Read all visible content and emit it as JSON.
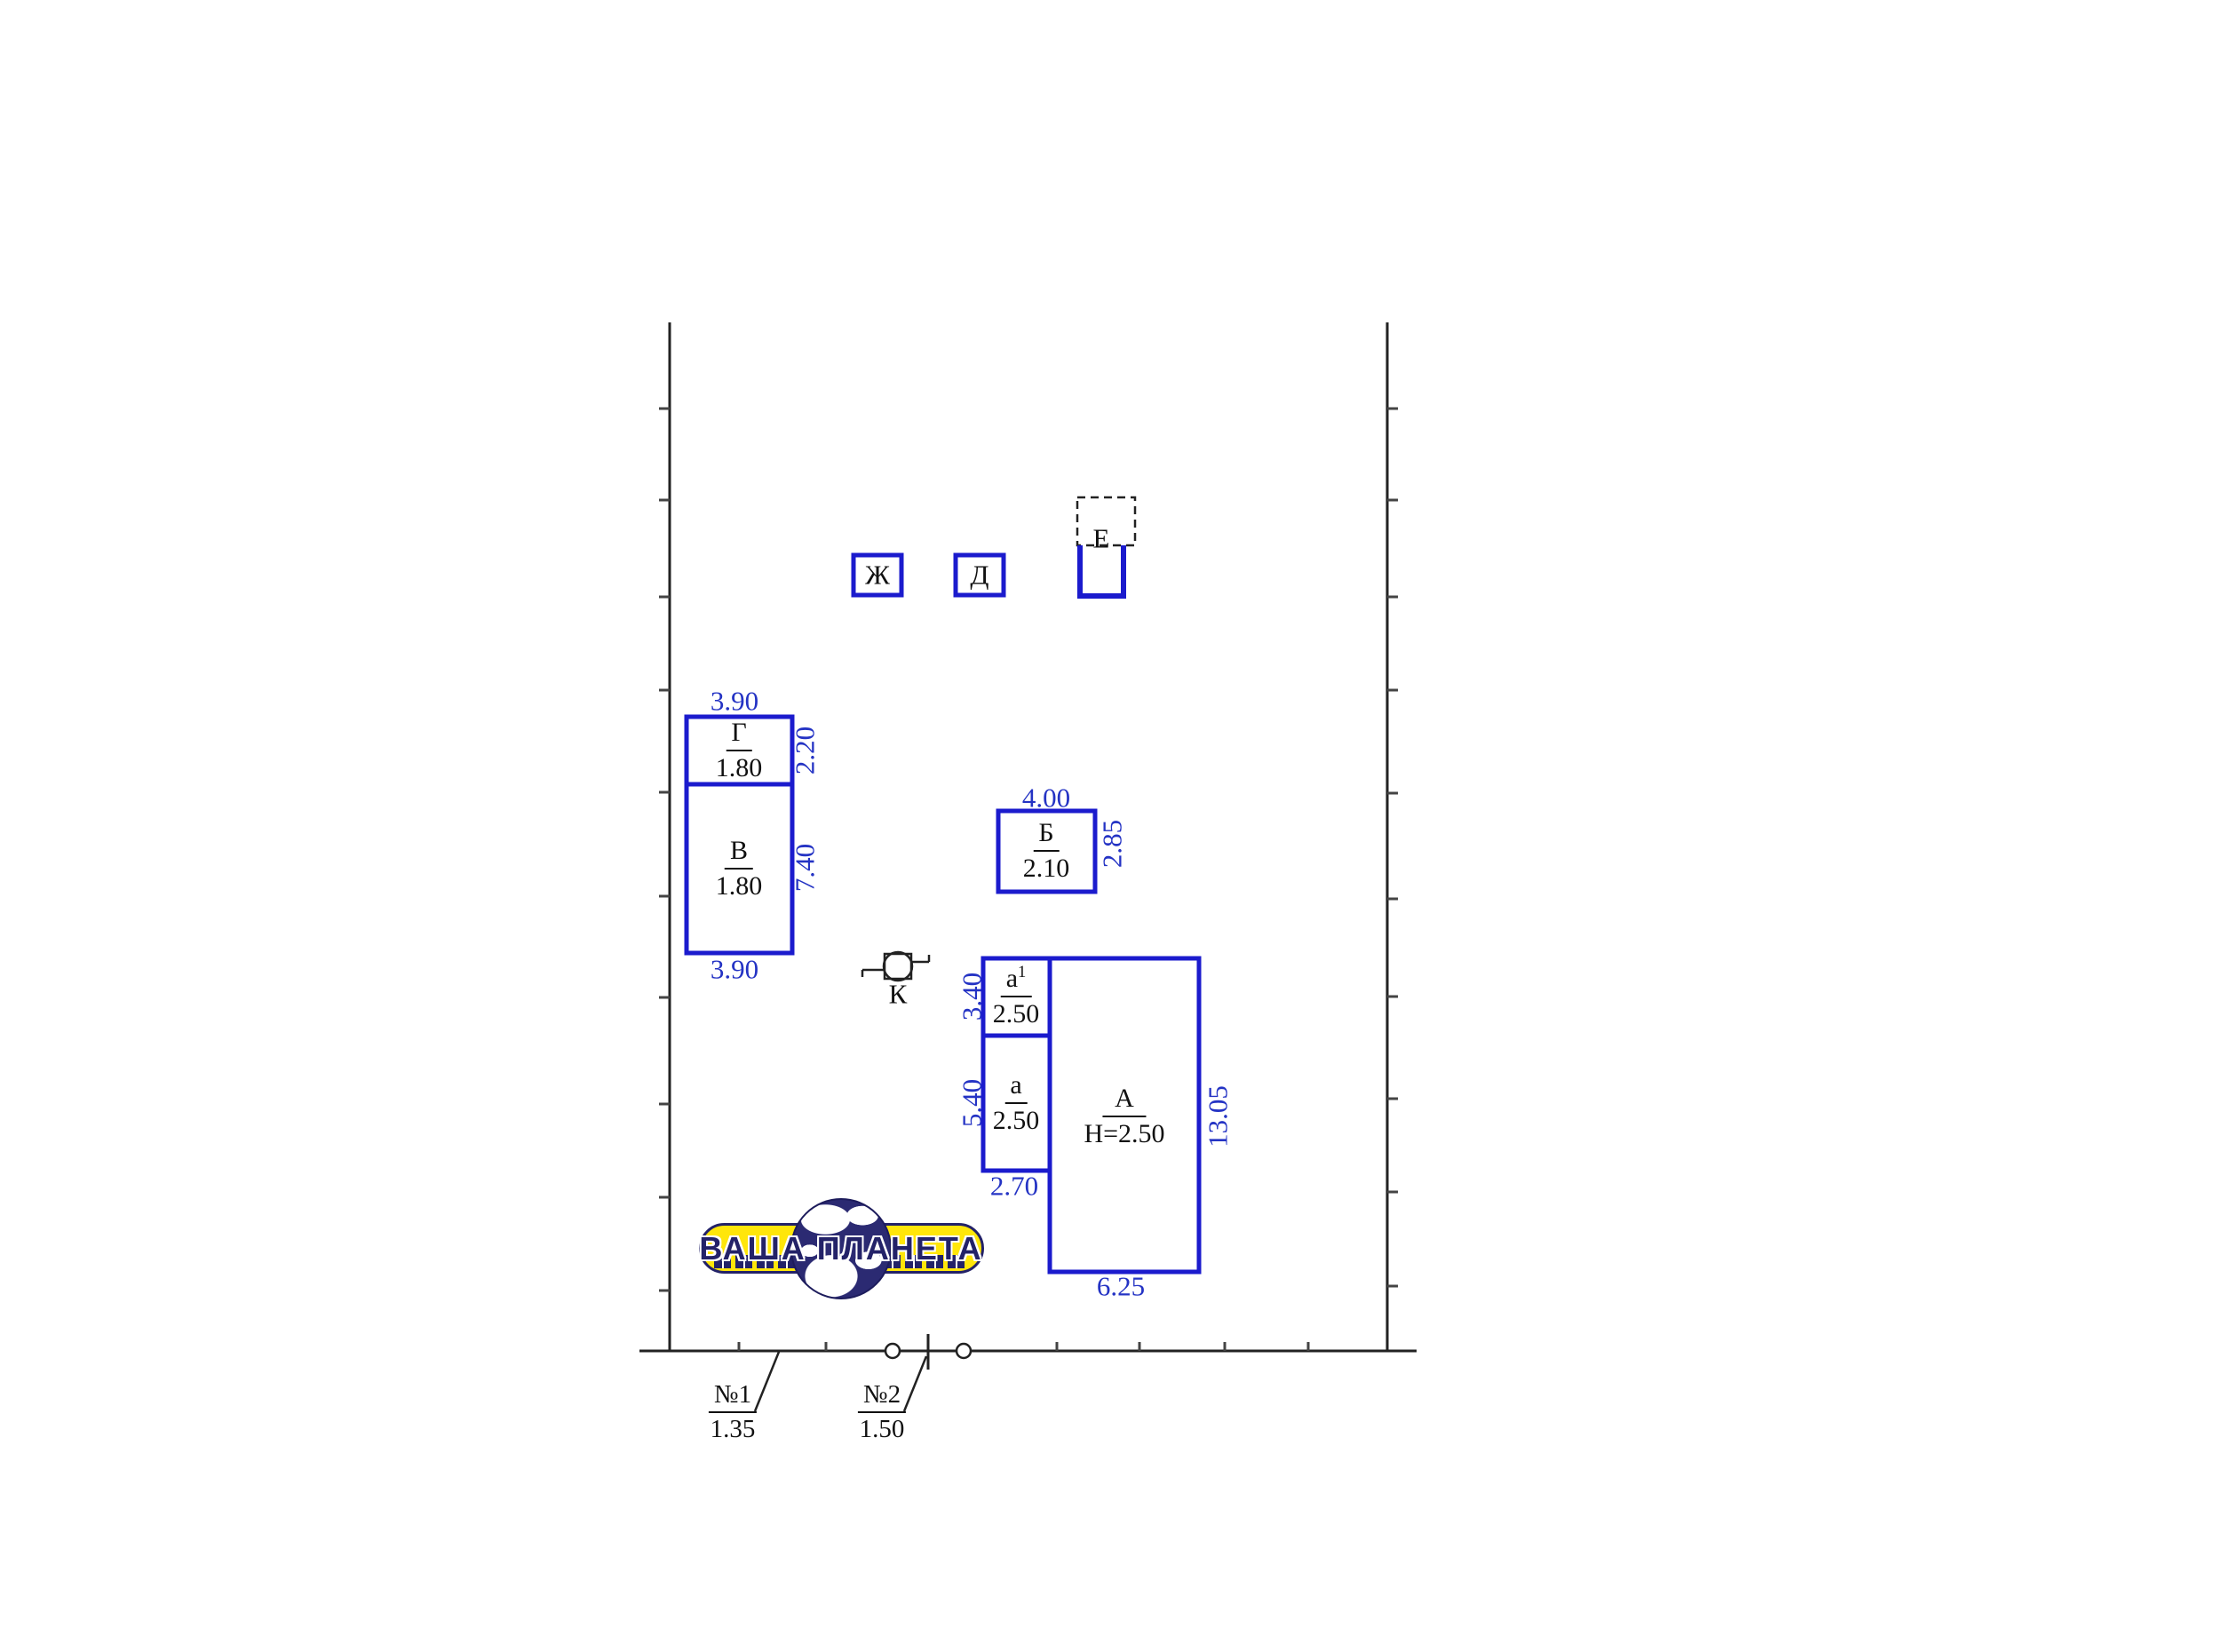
{
  "title": "Site plan sketch of land parcel with buildings",
  "colors": {
    "building_blue": "#1b1bcd",
    "dimension_text_blue": "#2433c4",
    "line_black": "#222222",
    "logo_yellow": "#ffe60a",
    "logo_navy": "#232268"
  },
  "buildings": {
    "zh": {
      "label": "Ж"
    },
    "d": {
      "label": "Д"
    },
    "e": {
      "label": "Е"
    },
    "g": {
      "label": "Г",
      "value": "1.80"
    },
    "v": {
      "label": "В",
      "value": "1.80"
    },
    "b": {
      "label": "Б",
      "value": "2.10"
    },
    "a1": {
      "label": "а",
      "sup": "1",
      "value": "2.50"
    },
    "a": {
      "label": "а",
      "value": "2.50"
    },
    "A": {
      "label": "А",
      "value": "Н=2.50"
    }
  },
  "well": {
    "label": "К"
  },
  "dimensions": {
    "g_top": "3.90",
    "g_right": "2.20",
    "v_right": "7.40",
    "v_bottom": "3.90",
    "b_top": "4.00",
    "b_right": "2.85",
    "a1_left": "3.40",
    "a_left": "5.40",
    "a_bottom": "2.70",
    "A_right": "13.05",
    "A_bottom": "6.25"
  },
  "marks": {
    "m1": {
      "label": "№1",
      "value": "1.35"
    },
    "m2": {
      "label": "№2",
      "value": "1.50"
    }
  },
  "logo": {
    "text": "ВАША ПЛАНЕТА"
  }
}
